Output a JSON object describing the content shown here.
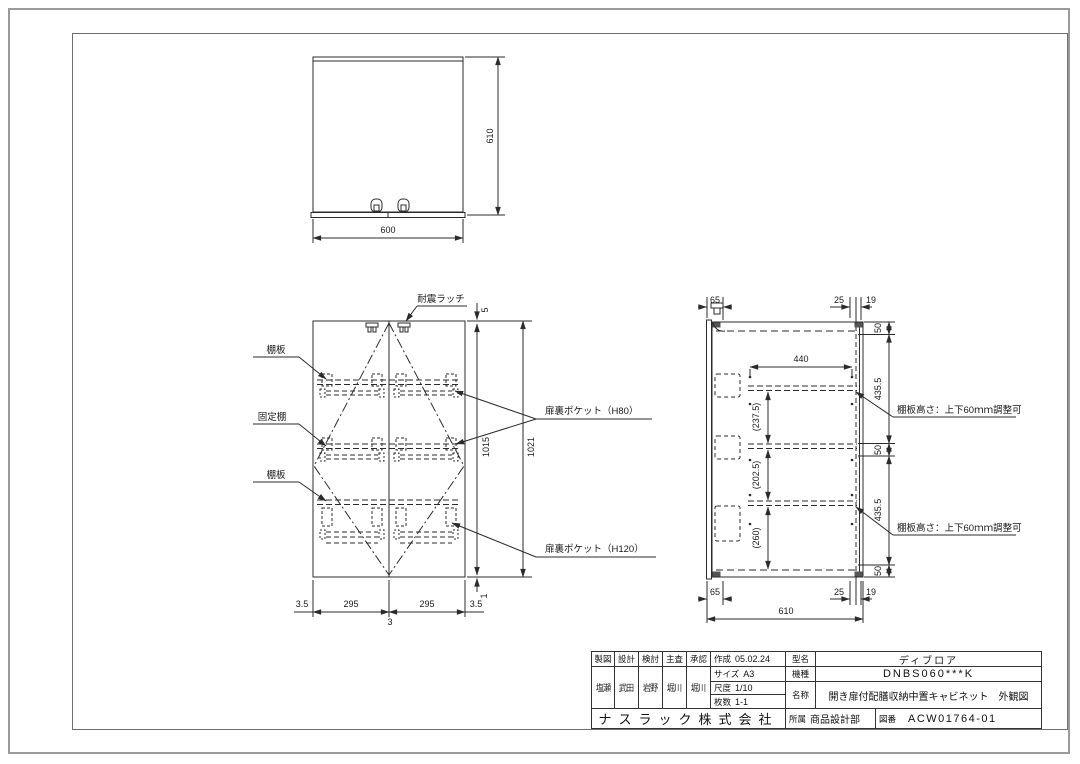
{
  "colors": {
    "paper": "#ffffff",
    "line": "#2b2b2b",
    "frame_outer": "#9a9a9a",
    "frame_inner": "#6f6f6f"
  },
  "views": {
    "top_view": {
      "dim_width": "600",
      "dim_depth": "610"
    },
    "front_view": {
      "labels": {
        "latch": "耐震ラッチ",
        "shelf_top": "棚板",
        "fixed_shelf": "固定棚",
        "shelf_bottom": "棚板",
        "pocket_h80": "扉裏ポケット（H80）",
        "pocket_h120": "扉裏ポケット（H120）"
      },
      "dims": {
        "top_gap": "5",
        "door_height": "1015",
        "total_height": "1021",
        "bottom_gap": "1",
        "left_gap": "3.5",
        "door_width_left": "295",
        "door_width_right": "295",
        "right_gap": "3.5",
        "center_gap": "3"
      }
    },
    "side_view": {
      "labels": {
        "shelf_note_top": "棚板高さ：上下60ｍｍ調整可",
        "shelf_note_bottom": "棚板高さ：上下60ｍｍ調整可"
      },
      "dims": {
        "top_front": "65",
        "top_back_offset": "25",
        "top_back_panel": "19",
        "seg_50_a": "50",
        "seg_435_a": "435.5",
        "seg_50_b": "50",
        "seg_435_b": "435.5",
        "seg_50_c": "50",
        "shelf_depth": "440",
        "clear_top": "(237.5)",
        "clear_mid": "(202.5)",
        "clear_bottom": "(260)",
        "bottom_front": "65",
        "bottom_back_offset": "25",
        "bottom_back_panel": "19",
        "total_depth": "610"
      }
    }
  },
  "title_block": {
    "approval_columns": [
      {
        "role": "製図",
        "name": "塩瀬"
      },
      {
        "role": "設計",
        "name": "武田"
      },
      {
        "role": "検討",
        "name": "岩野"
      },
      {
        "role": "主査",
        "name": "堀川"
      },
      {
        "role": "承認",
        "name": "堀川"
      }
    ],
    "created_label": "作成",
    "created_date": "05.02.24",
    "size_label": "サイズ",
    "size_value": "A3",
    "scale_label": "尺度",
    "scale_value": "1/10",
    "sheets_label": "枚数",
    "sheets_value": "1-1",
    "model_label": "型名",
    "model_value": "ディブロア",
    "series_label": "機種",
    "series_value": "DNBS060***K",
    "name_label": "名称",
    "name_value": "開き扉付配膳収納中置キャビネット　外観図",
    "company": "ナスラック株式会社",
    "dept_label": "所属",
    "dept_value": "商品設計部",
    "drawing_no_label": "図番",
    "drawing_no_value": "ACW01764-01"
  }
}
